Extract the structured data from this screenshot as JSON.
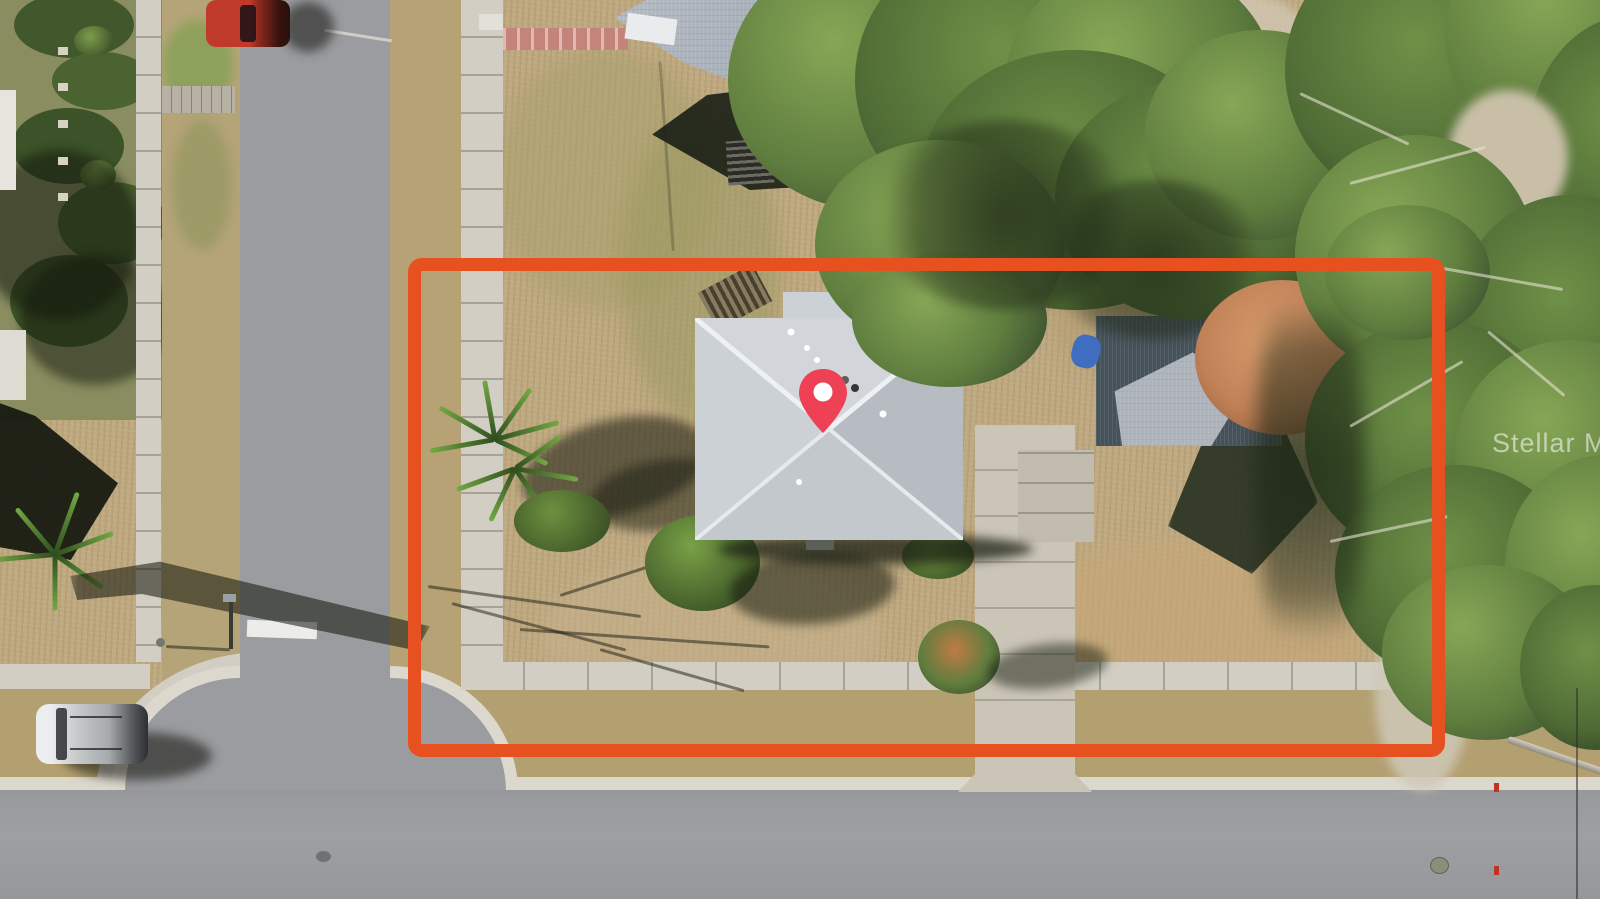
{
  "image": {
    "kind": "aerial-property-photo",
    "watermark_text": "Stellar MLS"
  },
  "overlay": {
    "boundary_shape": "property-outline-rectangle",
    "marker": "location-pin-icon"
  },
  "palette": {
    "boundary": "#E7511F",
    "pin": "#EE4156",
    "pinhole": "#FFFFFF",
    "road": "#9B9C9F",
    "curb": "#DCD8CD",
    "sidewalk": "#D2CEC3",
    "lawn": "#BFA981",
    "verge": "#B3A071",
    "roofmain": "#CCD1D6",
    "roofneighbor": "#A3ABB5",
    "shedshade": "#46525B",
    "shedlit": "#B6BDC3",
    "canopy": "#5F7D3E",
    "canopylight": "#8FAE5C",
    "canopydark": "#31412B",
    "fall": "#C08157",
    "walkwaypink": "#C4847C",
    "driveway": "#CBC5B7",
    "carred": "#B23227",
    "carsilver": "#C9CBCD",
    "tarpblue": "#3F6DC0"
  }
}
